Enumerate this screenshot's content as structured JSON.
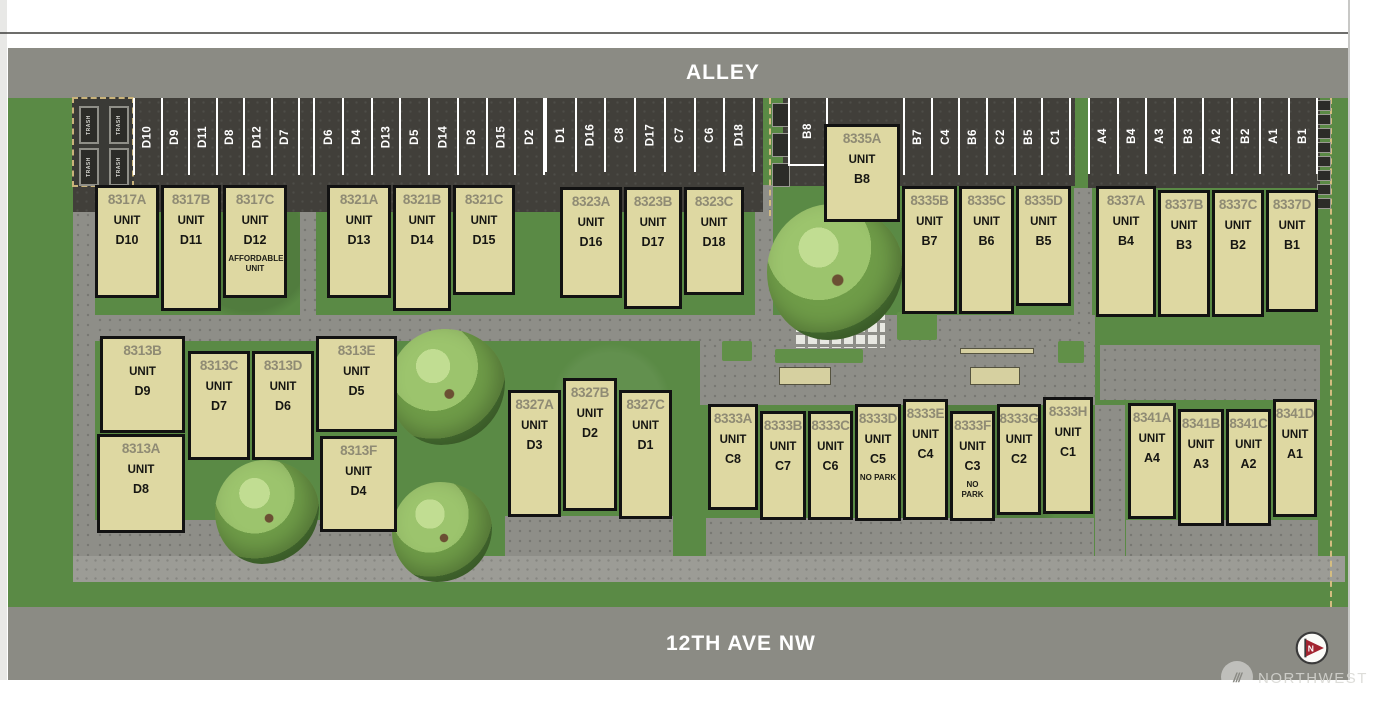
{
  "streets": {
    "alley": "ALLEY",
    "front": "12TH AVE NW"
  },
  "strings": {
    "unit": "UNIT",
    "trash": "TRASH"
  },
  "watermark": {
    "brand": "NORTHWEST",
    "flag_letter": "N",
    "slashes": "///"
  },
  "colors": {
    "grass": "#5a8a45",
    "pavement_dark": "#413f3a",
    "walkway": "#8e8e88",
    "road": "#8b8b84",
    "building_fill": "#ded8a2",
    "building_border": "#121212",
    "address_text": "#8f8b74",
    "stall_text": "#ffffff",
    "flag_red": "#a32430",
    "property_line": "#d4bd80"
  },
  "parking_rows": [
    {
      "name": "stalls-8317",
      "x": 133,
      "y": 98,
      "w": 167,
      "h": 77,
      "stalls": [
        "D10",
        "D9",
        "D11",
        "D8",
        "D12",
        "D7"
      ]
    },
    {
      "name": "stalls-8321",
      "x": 313,
      "y": 98,
      "w": 232,
      "h": 77,
      "stalls": [
        "D6",
        "D4",
        "D13",
        "D5",
        "D14",
        "D3",
        "D15",
        "D2"
      ]
    },
    {
      "name": "stalls-8323",
      "x": 545,
      "y": 98,
      "w": 210,
      "h": 74,
      "stalls": [
        "D1",
        "D16",
        "C8",
        "D17",
        "C7",
        "C6",
        "D18"
      ]
    },
    {
      "name": "stall-b8",
      "x": 788,
      "y": 98,
      "w": 40,
      "h": 68,
      "stalls": [
        "B8"
      ]
    },
    {
      "name": "stalls-8335",
      "x": 903,
      "y": 98,
      "w": 168,
      "h": 77,
      "stalls": [
        "B7",
        "C4",
        "B6",
        "C2",
        "B5",
        "C1"
      ]
    },
    {
      "name": "stalls-8337",
      "x": 1088,
      "y": 98,
      "w": 230,
      "h": 76,
      "stalls": [
        "A4",
        "B4",
        "A3",
        "B3",
        "A2",
        "B2",
        "A1",
        "B1"
      ]
    }
  ],
  "buildings": [
    {
      "address": "8317A",
      "unit": "D10",
      "note": "",
      "x": 95,
      "y": 185,
      "w": 64,
      "h": 113
    },
    {
      "address": "8317B",
      "unit": "D11",
      "note": "",
      "x": 161,
      "y": 185,
      "w": 60,
      "h": 126
    },
    {
      "address": "8317C",
      "unit": "D12",
      "note": "AFFORDABLE UNIT",
      "x": 223,
      "y": 185,
      "w": 64,
      "h": 113
    },
    {
      "address": "8321A",
      "unit": "D13",
      "note": "",
      "x": 327,
      "y": 185,
      "w": 64,
      "h": 113
    },
    {
      "address": "8321B",
      "unit": "D14",
      "note": "",
      "x": 393,
      "y": 185,
      "w": 58,
      "h": 126
    },
    {
      "address": "8321C",
      "unit": "D15",
      "note": "",
      "x": 453,
      "y": 185,
      "w": 62,
      "h": 110
    },
    {
      "address": "8323A",
      "unit": "D16",
      "note": "",
      "x": 560,
      "y": 187,
      "w": 62,
      "h": 111
    },
    {
      "address": "8323B",
      "unit": "D17",
      "note": "",
      "x": 624,
      "y": 187,
      "w": 58,
      "h": 122
    },
    {
      "address": "8323C",
      "unit": "D18",
      "note": "",
      "x": 684,
      "y": 187,
      "w": 60,
      "h": 108
    },
    {
      "address": "8335A",
      "unit": "B8",
      "note": "",
      "x": 824,
      "y": 124,
      "w": 76,
      "h": 98
    },
    {
      "address": "8335B",
      "unit": "B7",
      "note": "",
      "x": 902,
      "y": 186,
      "w": 55,
      "h": 128
    },
    {
      "address": "8335C",
      "unit": "B6",
      "note": "",
      "x": 959,
      "y": 186,
      "w": 55,
      "h": 128
    },
    {
      "address": "8335D",
      "unit": "B5",
      "note": "",
      "x": 1016,
      "y": 186,
      "w": 55,
      "h": 120
    },
    {
      "address": "8337A",
      "unit": "B4",
      "note": "",
      "x": 1096,
      "y": 186,
      "w": 60,
      "h": 131
    },
    {
      "address": "8337B",
      "unit": "B3",
      "note": "",
      "x": 1158,
      "y": 190,
      "w": 52,
      "h": 127
    },
    {
      "address": "8337C",
      "unit": "B2",
      "note": "",
      "x": 1212,
      "y": 190,
      "w": 52,
      "h": 127
    },
    {
      "address": "8337D",
      "unit": "B1",
      "note": "",
      "x": 1266,
      "y": 190,
      "w": 52,
      "h": 122
    },
    {
      "address": "8313B",
      "unit": "D9",
      "note": "",
      "x": 100,
      "y": 336,
      "w": 85,
      "h": 97
    },
    {
      "address": "8313A",
      "unit": "D8",
      "note": "",
      "x": 97,
      "y": 434,
      "w": 88,
      "h": 99
    },
    {
      "address": "8313C",
      "unit": "D7",
      "note": "",
      "x": 188,
      "y": 351,
      "w": 62,
      "h": 109
    },
    {
      "address": "8313D",
      "unit": "D6",
      "note": "",
      "x": 252,
      "y": 351,
      "w": 62,
      "h": 109
    },
    {
      "address": "8313E",
      "unit": "D5",
      "note": "",
      "x": 316,
      "y": 336,
      "w": 81,
      "h": 96
    },
    {
      "address": "8313F",
      "unit": "D4",
      "note": "",
      "x": 320,
      "y": 436,
      "w": 77,
      "h": 96
    },
    {
      "address": "8327A",
      "unit": "D3",
      "note": "",
      "x": 508,
      "y": 390,
      "w": 53,
      "h": 127
    },
    {
      "address": "8327B",
      "unit": "D2",
      "note": "",
      "x": 563,
      "y": 378,
      "w": 54,
      "h": 133
    },
    {
      "address": "8327C",
      "unit": "D1",
      "note": "",
      "x": 619,
      "y": 390,
      "w": 53,
      "h": 129
    },
    {
      "address": "8333A",
      "unit": "C8",
      "note": "",
      "x": 708,
      "y": 404,
      "w": 50,
      "h": 106
    },
    {
      "address": "8333B",
      "unit": "C7",
      "note": "",
      "x": 760,
      "y": 411,
      "w": 46,
      "h": 109
    },
    {
      "address": "8333C",
      "unit": "C6",
      "note": "",
      "x": 808,
      "y": 411,
      "w": 45,
      "h": 109
    },
    {
      "address": "8333D",
      "unit": "C5",
      "note": "NO PARK",
      "x": 855,
      "y": 404,
      "w": 46,
      "h": 117
    },
    {
      "address": "8333E",
      "unit": "C4",
      "note": "",
      "x": 903,
      "y": 399,
      "w": 45,
      "h": 121
    },
    {
      "address": "8333F",
      "unit": "C3",
      "note": "NO PARK",
      "x": 950,
      "y": 411,
      "w": 45,
      "h": 110
    },
    {
      "address": "8333G",
      "unit": "C2",
      "note": "",
      "x": 997,
      "y": 404,
      "w": 44,
      "h": 111
    },
    {
      "address": "8333H",
      "unit": "C1",
      "note": "",
      "x": 1043,
      "y": 397,
      "w": 50,
      "h": 117
    },
    {
      "address": "8341A",
      "unit": "A4",
      "note": "",
      "x": 1128,
      "y": 403,
      "w": 48,
      "h": 116
    },
    {
      "address": "8341B",
      "unit": "A3",
      "note": "",
      "x": 1178,
      "y": 409,
      "w": 46,
      "h": 117
    },
    {
      "address": "8341C",
      "unit": "A2",
      "note": "",
      "x": 1226,
      "y": 409,
      "w": 45,
      "h": 117
    },
    {
      "address": "8341D",
      "unit": "A1",
      "note": "",
      "x": 1273,
      "y": 399,
      "w": 44,
      "h": 118
    }
  ]
}
